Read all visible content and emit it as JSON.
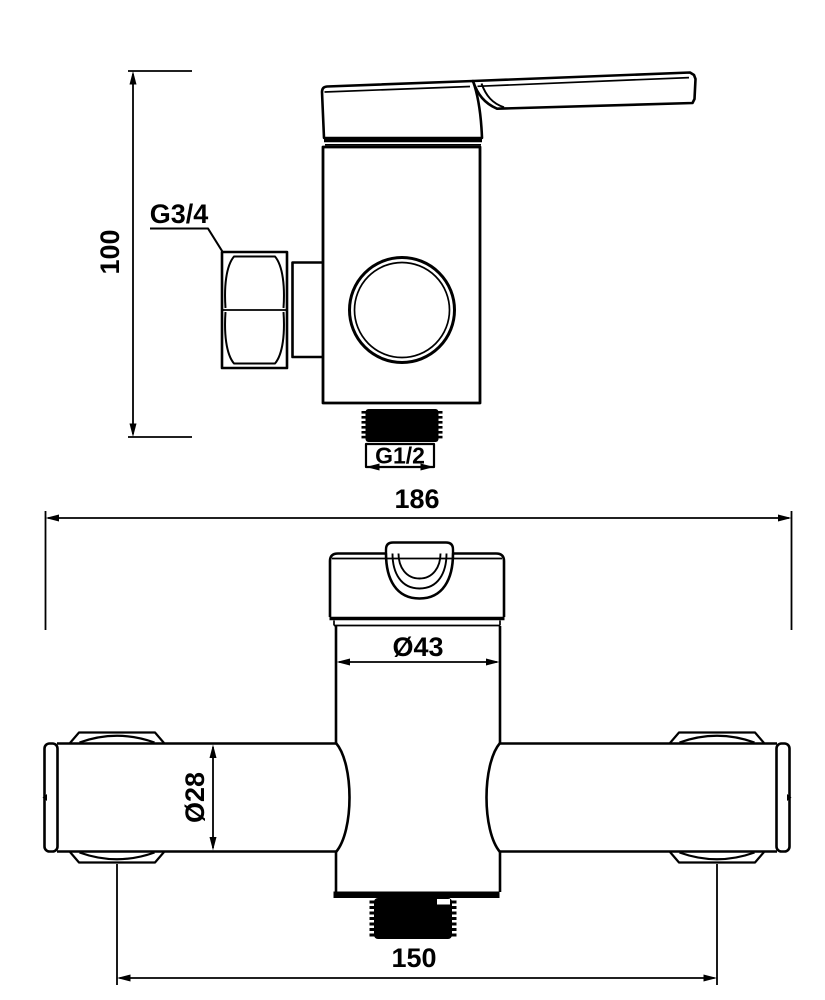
{
  "drawing": {
    "background": "#ffffff",
    "line_color": "#000000",
    "subject": "shower mixer faucet dimension drawing",
    "views": {
      "side": {
        "name": "side-view"
      },
      "front": {
        "name": "front-view"
      }
    },
    "labels": {
      "height": "100",
      "inlet_thread": "G3/4",
      "outlet_thread": "G1/2",
      "overall_width": "186",
      "body_diameter": "Ø43",
      "pipe_diameter": "Ø28",
      "connection_centers": "150"
    }
  }
}
